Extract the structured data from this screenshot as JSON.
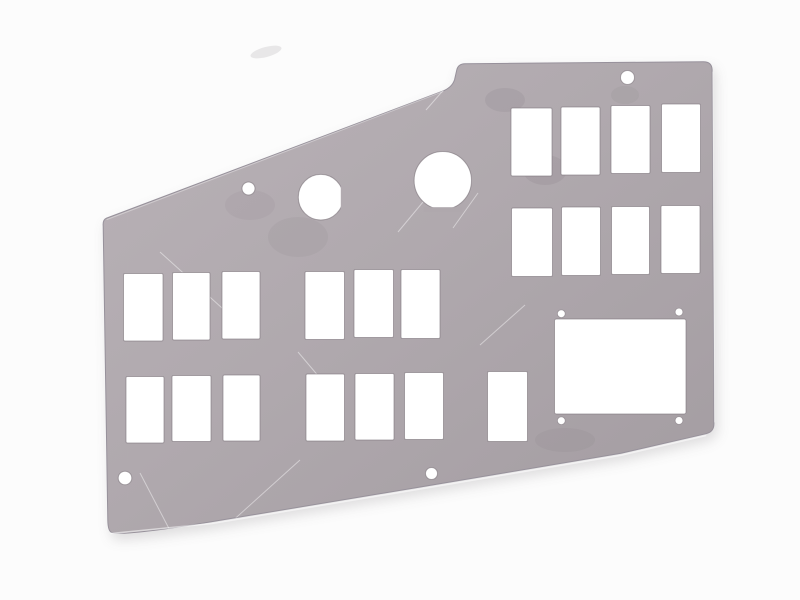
{
  "image": {
    "type": "product-photo",
    "subject": "bare sheet-metal instrument panel blank with punched switch cutouts, round holes and mounting holes on a white background",
    "background": {
      "color": "#fcfcfc",
      "smudge": {
        "cx": 266,
        "cy": 52,
        "rx": 16,
        "ry": 5,
        "rotate": -15,
        "color": "rgba(195,192,196,0.35)"
      }
    },
    "panel": {
      "outline_path": "M 107.8 520 L 103.2 226 Q 102.6 219.6 106.6 218.1 L 443.5 90.8 Q 452.3 86.9 454.6 79.6 L 456.8 69.8 Q 458.2 63.9 464.8 63.7 L 703.2 61.7 Q 711.6 61.6 712.1 69.4 L 713.9 423.5 Q 714.1 431.8 706.1 433.7 L 621 453.2 L 421 486.9 L 212 521.6 Q 120.5 536.8 111.2 532.2 Q 108 530.6 107.8 520 Z",
      "gradient_stops": [
        [
          "0%",
          "#b9b2b7"
        ],
        [
          "45%",
          "#b0a9ae"
        ],
        [
          "100%",
          "#a39ca1"
        ]
      ],
      "outline_stroke": "#97919b",
      "cutout_fill": "#ffffff",
      "cutout_stroke": "rgba(125,117,124,0.6)",
      "switch_cutouts": [
        {
          "group": "left-top-row",
          "rects": [
            [
              123.5,
              273.5,
              39.5,
              67.5
            ],
            [
              172.5,
              272.5,
              37.5,
              67.5
            ],
            [
              222,
              271.5,
              38,
              67.5
            ]
          ]
        },
        {
          "group": "left-bottom-row",
          "rects": [
            [
              126,
              376.5,
              38,
              66.5
            ],
            [
              172,
              375.5,
              39,
              66
            ],
            [
              223,
              375,
              37,
              66
            ]
          ]
        },
        {
          "group": "middle-top-row",
          "rects": [
            [
              305,
              271.5,
              39.5,
              68
            ],
            [
              354,
              269.5,
              39.5,
              68
            ],
            [
              401,
              269.5,
              39,
              69
            ]
          ]
        },
        {
          "group": "middle-bottom-row",
          "rects": [
            [
              306,
              374,
              38.5,
              67
            ],
            [
              355,
              373.5,
              39,
              66.5
            ],
            [
              404.5,
              372.5,
              39,
              67
            ],
            [
              487.5,
              371.5,
              40,
              70
            ]
          ]
        },
        {
          "group": "right-top-row",
          "rects": [
            [
              511,
              108,
              41,
              68
            ],
            [
              561,
              107,
              39,
              68
            ],
            [
              611,
              105.5,
              39,
              68
            ],
            [
              661.5,
              104,
              39,
              68.5
            ]
          ]
        },
        {
          "group": "right-middle-row",
          "rects": [
            [
              511.5,
              208,
              41,
              68.5
            ],
            [
              561.5,
              207,
              39,
              68.5
            ],
            [
              611.5,
              206.5,
              38,
              68
            ],
            [
              661,
              205.5,
              39,
              68
            ]
          ]
        }
      ],
      "display_cutout": {
        "x": 554.5,
        "y": 319,
        "w": 131.5,
        "h": 95,
        "corner_holes": [
          [
            561.3,
            313.7,
            3.9
          ],
          [
            679,
            312,
            3.9
          ],
          [
            561.3,
            420.7,
            3.9
          ],
          [
            679,
            420.5,
            3.9
          ]
        ]
      },
      "round_cutouts": [
        {
          "cx": 320.8,
          "cy": 197.2,
          "rx": 22.5,
          "ry": 22.8,
          "flat": {
            "x": 340.8,
            "y": 186.5,
            "w": 5,
            "h": 22,
            "color": "#b2abb0"
          }
        },
        {
          "cx": 442.8,
          "cy": 180.5,
          "rx": 28.7,
          "ry": 29,
          "flat": {
            "x": 423.5,
            "y": 207.2,
            "w": 39,
            "h": 4.5,
            "color": "#afa8ad"
          }
        }
      ],
      "mounting_holes": [
        [
          248.5,
          188.5,
          6.5
        ],
        [
          627.5,
          77.5,
          7
        ],
        [
          125,
          478,
          6.8
        ],
        [
          431.5,
          473.5,
          6
        ]
      ],
      "edge_highlights": [
        {
          "d": "M 111 533.5 L 212 523.5 L 421 488.8 L 621 455.2 L 705.5 435.6",
          "color": "rgba(255,255,255,0.55)",
          "w": 1.6
        },
        {
          "d": "M 712.8 72 L 714.6 422",
          "color": "rgba(255,255,255,0.4)",
          "w": 1
        },
        {
          "d": "M 107 219.5 L 443 91.5",
          "color": "rgba(255,255,255,0.35)",
          "w": 1
        }
      ],
      "scratches": [
        [
          160,
          252,
          253,
          336
        ],
        [
          298,
          352,
          342,
          404
        ],
        [
          140,
          473,
          176,
          542
        ],
        [
          208,
          543,
          300,
          460
        ],
        [
          398,
          232,
          428,
          196
        ],
        [
          453,
          228,
          478,
          193
        ],
        [
          426,
          110,
          447,
          86
        ],
        [
          480,
          345,
          525,
          305
        ]
      ],
      "scratch_color": "rgba(255,255,255,0.45)",
      "smudges": [
        [
          505,
          100,
          20,
          12,
          0.1
        ],
        [
          545,
          170,
          22,
          15,
          0.1
        ],
        [
          298,
          237,
          30,
          20,
          0.07
        ],
        [
          580,
          118,
          16,
          10,
          0.08
        ],
        [
          565,
          440,
          30,
          12,
          0.07
        ],
        [
          250,
          205,
          25,
          15,
          0.06
        ],
        [
          625,
          95,
          14,
          9,
          0.07
        ]
      ],
      "smudge_color": "100,93,100"
    }
  }
}
